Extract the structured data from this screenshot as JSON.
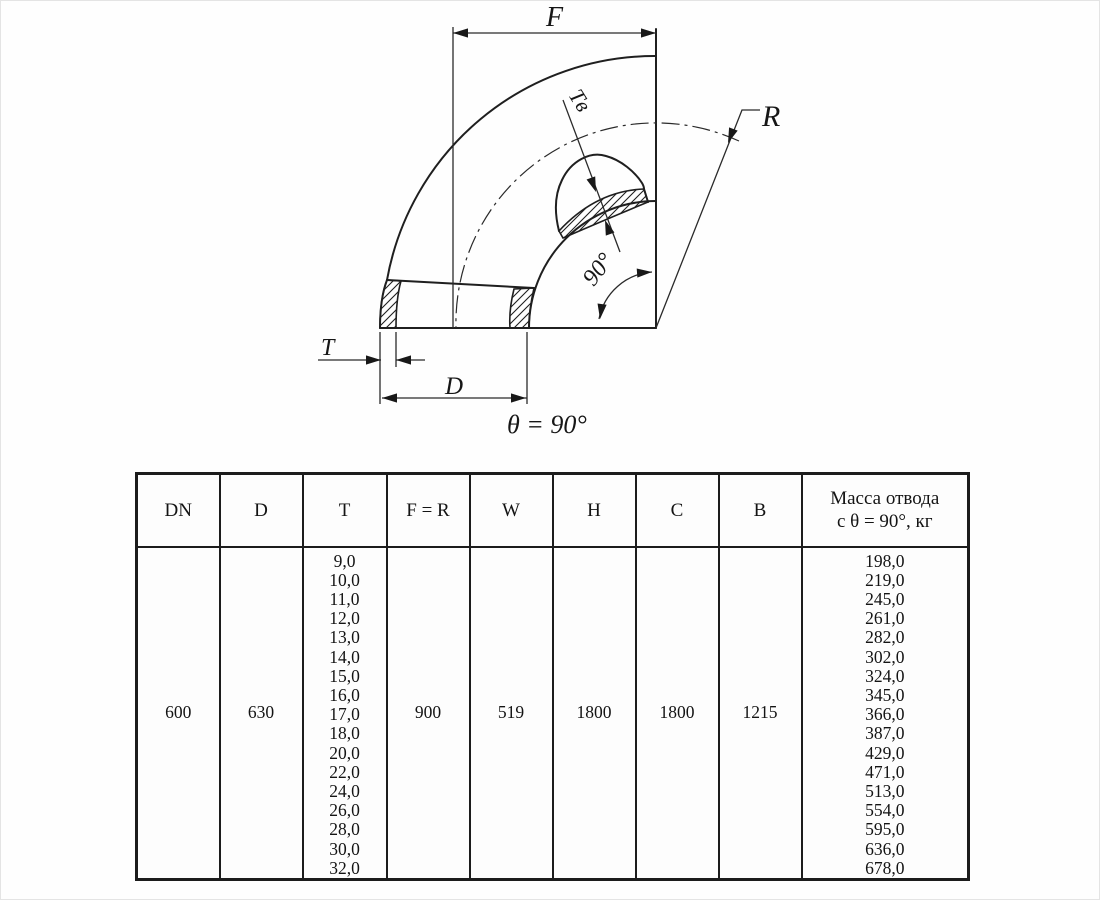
{
  "diagram": {
    "labels": {
      "f": "F",
      "r": "R",
      "t": "T",
      "d": "D",
      "tv": "Tв",
      "angle": "90°",
      "theta": "θ = 90°"
    }
  },
  "table": {
    "headers": {
      "dn": "DN",
      "d": "D",
      "t": "T",
      "fr": "F = R",
      "w": "W",
      "h": "H",
      "c": "C",
      "b": "B",
      "mass_line1": "Масса отвода",
      "mass_line2": "с θ = 90°, кг"
    },
    "row": {
      "dn": "600",
      "d": "630",
      "t_values": [
        "9,0",
        "10,0",
        "11,0",
        "12,0",
        "13,0",
        "14,0",
        "15,0",
        "16,0",
        "17,0",
        "18,0",
        "20,0",
        "22,0",
        "24,0",
        "26,0",
        "28,0",
        "30,0",
        "32,0"
      ],
      "fr": "900",
      "w": "519",
      "h": "1800",
      "c": "1800",
      "b": "1215",
      "mass_values": [
        "198,0",
        "219,0",
        "245,0",
        "261,0",
        "282,0",
        "302,0",
        "324,0",
        "345,0",
        "366,0",
        "387,0",
        "429,0",
        "471,0",
        "513,0",
        "554,0",
        "595,0",
        "636,0",
        "678,0"
      ]
    }
  }
}
